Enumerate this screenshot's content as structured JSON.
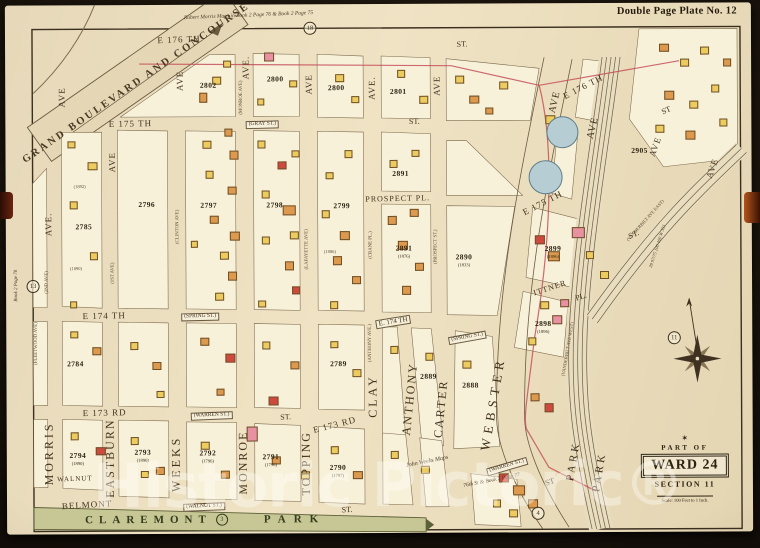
{
  "plate": {
    "title": "Double Page Plate No. 12"
  },
  "watermark": "Historic Pictoric®",
  "badge": {
    "part_of": "PART OF",
    "ward": "WARD 24",
    "section": "SECTION 11",
    "scale": "Scale: 100 Feet to 1 Inch."
  },
  "park": {
    "name_a": "CLAREMONT",
    "circled": "3",
    "name_b": "PARK"
  },
  "boulevard": "GRAND BOULEVARD AND CONCOURSE",
  "notes": {
    "top_script": "Robert Morris Maps in Book 2 Page 76 & Book 2 Page 75",
    "left_script": "Book 2 Page 78",
    "weeks_script_1": "John Weeks Maps",
    "weeks_script_2": "76th St & Book 2 Page 77",
    "rail_note": "39 97/75 100 400 W 351"
  },
  "colors": {
    "sheet": "#ecdfc0",
    "ink": "#42331f",
    "park_green": "#c6c795",
    "rail_brown": "#6d5c44",
    "ward_line_red": "#c5505a",
    "water_blue": "#b7cdd4",
    "bldg_yellow": "#eccb5f",
    "bldg_orange": "#dd9a4e",
    "bldg_pink": "#e891a0",
    "bldg_red": "#cf4a3e"
  },
  "labels": [
    [
      "E 176 TH",
      180,
      39,
      -2,
      9,
      1,
      ""
    ],
    [
      "ST.",
      463,
      45,
      -3,
      8,
      0,
      ""
    ],
    [
      "E 176 TH",
      584,
      88,
      -27,
      9,
      1,
      ""
    ],
    [
      "ST",
      667,
      112,
      -25,
      8,
      0,
      ""
    ],
    [
      "E 175 TH",
      131,
      123,
      -1,
      9,
      1,
      ""
    ],
    [
      "(GRAY ST.)",
      263,
      124,
      -1,
      5.5,
      0,
      "boxed"
    ],
    [
      "ST.",
      415,
      122,
      -1,
      8,
      0,
      ""
    ],
    [
      "E 175 TH",
      543,
      204,
      -27,
      9,
      1,
      ""
    ],
    [
      "ST.",
      634,
      236,
      -24,
      8,
      0,
      ""
    ],
    [
      "PROSPECT PL.",
      398,
      199,
      -1,
      8,
      1,
      ""
    ],
    [
      "E 174 TH",
      104,
      315,
      -1,
      9,
      1,
      ""
    ],
    [
      "(SPRING ST.)",
      200,
      316,
      -1,
      5.5,
      0,
      "boxed"
    ],
    [
      "E. 174 TH",
      393,
      322,
      -9,
      7,
      0,
      "boxed"
    ],
    [
      "(SPRING ST.)",
      467,
      338,
      -10,
      5.5,
      0,
      "boxed"
    ],
    [
      "ITTNER",
      550,
      289,
      -18,
      8,
      1,
      ""
    ],
    [
      "PL.",
      581,
      298,
      -18,
      8,
      0,
      ""
    ],
    [
      "E 173 RD",
      104,
      412,
      -1,
      9,
      1,
      ""
    ],
    [
      "(WARREN ST.)",
      211,
      415,
      -2,
      5.5,
      0,
      "boxed"
    ],
    [
      "ST.",
      285,
      417,
      -3,
      8,
      0,
      ""
    ],
    [
      "E 173 RD",
      334,
      425,
      -14,
      9,
      1,
      ""
    ],
    [
      "(WARREN ST.)",
      506,
      467,
      -16,
      5.5,
      0,
      "boxed"
    ],
    [
      "ST",
      549,
      483,
      -18,
      8,
      0,
      ""
    ],
    [
      "WALNUT",
      74,
      478,
      -2,
      7,
      1,
      ""
    ],
    [
      "(WALNUT ST.)",
      203,
      506,
      -2,
      5.5,
      0,
      "boxed"
    ],
    [
      "ST.",
      346,
      510,
      -2,
      8,
      0,
      ""
    ],
    [
      "BELMONT",
      86,
      504,
      -3,
      9,
      1,
      ""
    ],
    [
      "AVE",
      63,
      96,
      -90,
      9,
      1,
      ""
    ],
    [
      "AVE.",
      49,
      223,
      -90,
      9,
      1,
      ""
    ],
    [
      "MORRIS",
      48,
      452,
      -90,
      12,
      3,
      ""
    ],
    [
      "(FLEETWOOD AVE)",
      37,
      342,
      -90,
      4.8,
      0,
      "old"
    ],
    [
      "(2ND AVE)",
      48,
      281,
      -90,
      4.8,
      0,
      "old"
    ],
    [
      "AVE",
      113,
      161,
      -90,
      9,
      1,
      ""
    ],
    [
      "(1ST AVE)",
      114,
      272,
      -90,
      4.8,
      0,
      "old"
    ],
    [
      "EASTBURN",
      109,
      457,
      -90,
      12,
      2,
      ""
    ],
    [
      "AVE",
      181,
      80,
      -90,
      9,
      1,
      ""
    ],
    [
      "(CLINTON AVE)",
      179,
      226,
      -90,
      4.8,
      0,
      "old"
    ],
    [
      "WEEKS",
      175,
      463,
      -90,
      12,
      3,
      ""
    ],
    [
      "AVE.",
      247,
      67,
      -90,
      9,
      1,
      ""
    ],
    [
      "(MONROE AVE)",
      243,
      97,
      -90,
      4.8,
      0,
      "old"
    ],
    [
      "MONROE",
      242,
      462,
      -90,
      12,
      2,
      ""
    ],
    [
      "AVE",
      310,
      84,
      -90,
      9,
      1,
      ""
    ],
    [
      "(LAFAYETTE AVE)",
      308,
      249,
      -90,
      4.8,
      0,
      "old"
    ],
    [
      "TOPPING",
      305,
      463,
      -90,
      12,
      2,
      ""
    ],
    [
      "AVE.",
      373,
      88,
      -90,
      9,
      1,
      ""
    ],
    [
      "(CRANE PL.)",
      372,
      245,
      -90,
      4.8,
      0,
      "old"
    ],
    [
      "(ANTHONY AVE.)",
      371,
      343,
      -90,
      4.8,
      0,
      "old"
    ],
    [
      "CLAY",
      372,
      396,
      -90,
      12,
      3,
      ""
    ],
    [
      "AVE",
      438,
      86,
      -90,
      9,
      1,
      ""
    ],
    [
      "(PROSPECT ST.)",
      437,
      247,
      -90,
      4.8,
      0,
      "old"
    ],
    [
      "ANTHONY",
      409,
      399,
      -84,
      12,
      2,
      ""
    ],
    [
      "CARTER",
      440,
      409,
      -84,
      12,
      2,
      ""
    ],
    [
      "WEBSTER",
      492,
      404,
      -80,
      13,
      5,
      ""
    ],
    [
      "AVE",
      556,
      103,
      -76,
      10,
      1,
      ""
    ],
    [
      "AVE",
      594,
      129,
      -76,
      10,
      1,
      ""
    ],
    [
      "PARK",
      573,
      462,
      -80,
      11,
      3,
      ""
    ],
    [
      "PARK",
      599,
      473,
      -80,
      11,
      3,
      ""
    ],
    [
      "(VANDERBILT AVE WEST)",
      568,
      350,
      -80,
      4.6,
      0,
      "old"
    ],
    [
      "(VANDERBILT AVE EAST)",
      646,
      222,
      -48,
      4.6,
      0,
      "old"
    ],
    [
      "AVE",
      656,
      148,
      -70,
      9,
      1,
      ""
    ],
    [
      "AVE",
      713,
      170,
      -70,
      9,
      1,
      ""
    ],
    [
      "(1892)",
      80,
      186,
      0,
      4.5,
      0,
      "old"
    ],
    [
      "(1890)",
      76,
      268,
      0,
      4.5,
      0,
      "old"
    ],
    [
      "(1886)",
      330,
      252,
      0,
      4.5,
      0,
      "old"
    ]
  ],
  "blocks": [
    [
      "2802",
      "",
      209,
      83
    ],
    [
      "2800",
      "",
      276,
      77
    ],
    [
      "2800",
      "",
      337,
      86
    ],
    [
      "2801",
      "",
      399,
      90
    ],
    [
      "2905",
      "",
      640,
      150
    ],
    [
      "2785",
      "",
      84,
      224
    ],
    [
      "2796",
      "",
      147,
      202
    ],
    [
      "2797",
      "",
      209,
      203
    ],
    [
      "2798",
      "",
      275,
      203
    ],
    [
      "2799",
      "",
      342,
      204
    ],
    [
      "2891",
      "",
      401,
      172
    ],
    [
      "2891",
      "(1876)",
      404,
      249
    ],
    [
      "2890",
      "(1833)",
      464,
      258
    ],
    [
      "2899",
      "(1896)",
      553,
      250
    ],
    [
      "2898",
      "(1896)",
      543,
      325
    ],
    [
      "2784",
      "",
      75,
      361
    ],
    [
      "2789",
      "",
      338,
      362
    ],
    [
      "2889",
      "",
      428,
      375
    ],
    [
      "2888",
      "",
      470,
      384
    ],
    [
      "2794",
      "(1890)",
      77,
      455
    ],
    [
      "2793",
      "(1890)",
      142,
      452
    ],
    [
      "2792",
      "(1796)",
      207,
      453
    ],
    [
      "2791",
      "(1796)",
      270,
      457
    ],
    [
      "2790",
      "(1797)",
      337,
      468
    ]
  ],
  "circled_numbers": [
    [
      "18",
      311,
      28
    ],
    [
      "13",
      33,
      285
    ],
    [
      "11",
      674,
      339
    ],
    [
      "4",
      537,
      514
    ]
  ],
  "tanks": [
    [
      563,
      133,
      15
    ],
    [
      546,
      178,
      16
    ]
  ],
  "buildings": [
    [
      265,
      52,
      10,
      9,
      "p"
    ],
    [
      224,
      60,
      8,
      7,
      "y"
    ],
    [
      213,
      76,
      9,
      8,
      "y"
    ],
    [
      200,
      92,
      8,
      10,
      "o"
    ],
    [
      290,
      80,
      8,
      7,
      "y"
    ],
    [
      258,
      98,
      7,
      7,
      "y"
    ],
    [
      336,
      74,
      9,
      8,
      "y"
    ],
    [
      352,
      96,
      8,
      7,
      "y"
    ],
    [
      398,
      70,
      8,
      8,
      "y"
    ],
    [
      420,
      96,
      9,
      8,
      "y"
    ],
    [
      456,
      76,
      9,
      8,
      "y"
    ],
    [
      470,
      96,
      10,
      8,
      "o"
    ],
    [
      500,
      82,
      9,
      8,
      "y"
    ],
    [
      486,
      108,
      8,
      7,
      "o"
    ],
    [
      203,
      140,
      9,
      8,
      "y"
    ],
    [
      225,
      128,
      8,
      8,
      "o"
    ],
    [
      230,
      150,
      9,
      9,
      "o"
    ],
    [
      206,
      170,
      8,
      8,
      "y"
    ],
    [
      228,
      186,
      9,
      8,
      "o"
    ],
    [
      210,
      215,
      9,
      8,
      "o"
    ],
    [
      230,
      231,
      10,
      9,
      "o"
    ],
    [
      220,
      251,
      9,
      8,
      "y"
    ],
    [
      228,
      271,
      9,
      9,
      "o"
    ],
    [
      215,
      292,
      9,
      8,
      "y"
    ],
    [
      191,
      240,
      7,
      7,
      "y"
    ],
    [
      258,
      140,
      8,
      8,
      "y"
    ],
    [
      278,
      161,
      9,
      8,
      "r"
    ],
    [
      292,
      150,
      8,
      7,
      "y"
    ],
    [
      262,
      190,
      8,
      8,
      "y"
    ],
    [
      283,
      205,
      13,
      10,
      "o"
    ],
    [
      290,
      231,
      9,
      8,
      "y"
    ],
    [
      262,
      236,
      8,
      8,
      "y"
    ],
    [
      285,
      261,
      9,
      9,
      "o"
    ],
    [
      292,
      286,
      8,
      8,
      "r"
    ],
    [
      258,
      300,
      8,
      7,
      "y"
    ],
    [
      322,
      210,
      8,
      8,
      "y"
    ],
    [
      340,
      231,
      10,
      9,
      "o"
    ],
    [
      333,
      256,
      9,
      9,
      "o"
    ],
    [
      352,
      276,
      9,
      8,
      "o"
    ],
    [
      330,
      301,
      8,
      8,
      "y"
    ],
    [
      345,
      150,
      8,
      8,
      "y"
    ],
    [
      326,
      172,
      8,
      7,
      "y"
    ],
    [
      388,
      216,
      9,
      9,
      "o"
    ],
    [
      410,
      209,
      9,
      8,
      "o"
    ],
    [
      398,
      241,
      10,
      9,
      "o"
    ],
    [
      415,
      263,
      9,
      8,
      "o"
    ],
    [
      402,
      286,
      9,
      9,
      "o"
    ],
    [
      390,
      160,
      8,
      8,
      "y"
    ],
    [
      412,
      150,
      8,
      7,
      "y"
    ],
    [
      68,
      140,
      8,
      7,
      "y"
    ],
    [
      88,
      161,
      10,
      8,
      "y"
    ],
    [
      70,
      200,
      8,
      8,
      "y"
    ],
    [
      90,
      251,
      8,
      8,
      "y"
    ],
    [
      70,
      300,
      7,
      7,
      "y"
    ],
    [
      70,
      330,
      8,
      7,
      "y"
    ],
    [
      92,
      346,
      9,
      8,
      "o"
    ],
    [
      130,
      341,
      8,
      8,
      "y"
    ],
    [
      152,
      361,
      9,
      8,
      "o"
    ],
    [
      200,
      337,
      9,
      8,
      "o"
    ],
    [
      225,
      353,
      10,
      9,
      "r"
    ],
    [
      262,
      341,
      8,
      8,
      "y"
    ],
    [
      290,
      361,
      9,
      8,
      "o"
    ],
    [
      330,
      341,
      8,
      7,
      "y"
    ],
    [
      352,
      369,
      9,
      8,
      "y"
    ],
    [
      390,
      346,
      8,
      8,
      "y"
    ],
    [
      425,
      353,
      8,
      8,
      "y"
    ],
    [
      462,
      361,
      9,
      8,
      "y"
    ],
    [
      156,
      390,
      8,
      7,
      "y"
    ],
    [
      216,
      388,
      8,
      7,
      "o"
    ],
    [
      70,
      431,
      8,
      8,
      "y"
    ],
    [
      95,
      446,
      10,
      8,
      "r"
    ],
    [
      130,
      436,
      8,
      8,
      "y"
    ],
    [
      155,
      466,
      9,
      8,
      "o"
    ],
    [
      200,
      441,
      9,
      8,
      "y"
    ],
    [
      246,
      426,
      11,
      15,
      "p"
    ],
    [
      268,
      396,
      10,
      9,
      "r"
    ],
    [
      271,
      456,
      9,
      8,
      "o"
    ],
    [
      300,
      471,
      9,
      8,
      "y"
    ],
    [
      330,
      446,
      8,
      8,
      "y"
    ],
    [
      352,
      471,
      10,
      8,
      "o"
    ],
    [
      390,
      451,
      8,
      8,
      "y"
    ],
    [
      420,
      466,
      9,
      8,
      "y"
    ],
    [
      140,
      470,
      8,
      7,
      "y"
    ],
    [
      220,
      470,
      9,
      8,
      "o"
    ],
    [
      546,
      116,
      10,
      9,
      "y"
    ],
    [
      560,
      130,
      9,
      8,
      "o"
    ],
    [
      535,
      236,
      10,
      9,
      "r"
    ],
    [
      548,
      252,
      12,
      10,
      "o"
    ],
    [
      540,
      302,
      9,
      8,
      "y"
    ],
    [
      552,
      316,
      10,
      9,
      "p"
    ],
    [
      528,
      338,
      8,
      8,
      "y"
    ],
    [
      530,
      394,
      9,
      8,
      "o"
    ],
    [
      544,
      404,
      9,
      9,
      "r"
    ],
    [
      572,
      228,
      13,
      11,
      "p"
    ],
    [
      560,
      300,
      9,
      8,
      "p"
    ],
    [
      586,
      252,
      8,
      8,
      "y"
    ],
    [
      600,
      272,
      9,
      8,
      "y"
    ],
    [
      498,
      474,
      10,
      9,
      "r"
    ],
    [
      512,
      486,
      12,
      10,
      "o"
    ],
    [
      527,
      500,
      10,
      9,
      "o"
    ],
    [
      492,
      500,
      8,
      8,
      "y"
    ],
    [
      508,
      510,
      9,
      8,
      "y"
    ],
    [
      660,
      45,
      10,
      8,
      "o"
    ],
    [
      681,
      60,
      9,
      8,
      "y"
    ],
    [
      701,
      48,
      9,
      8,
      "y"
    ],
    [
      665,
      92,
      10,
      9,
      "o"
    ],
    [
      690,
      102,
      9,
      8,
      "y"
    ],
    [
      712,
      86,
      8,
      8,
      "y"
    ],
    [
      656,
      126,
      9,
      8,
      "y"
    ],
    [
      686,
      132,
      10,
      9,
      "o"
    ],
    [
      720,
      120,
      8,
      8,
      "y"
    ],
    [
      724,
      60,
      8,
      8,
      "o"
    ]
  ]
}
